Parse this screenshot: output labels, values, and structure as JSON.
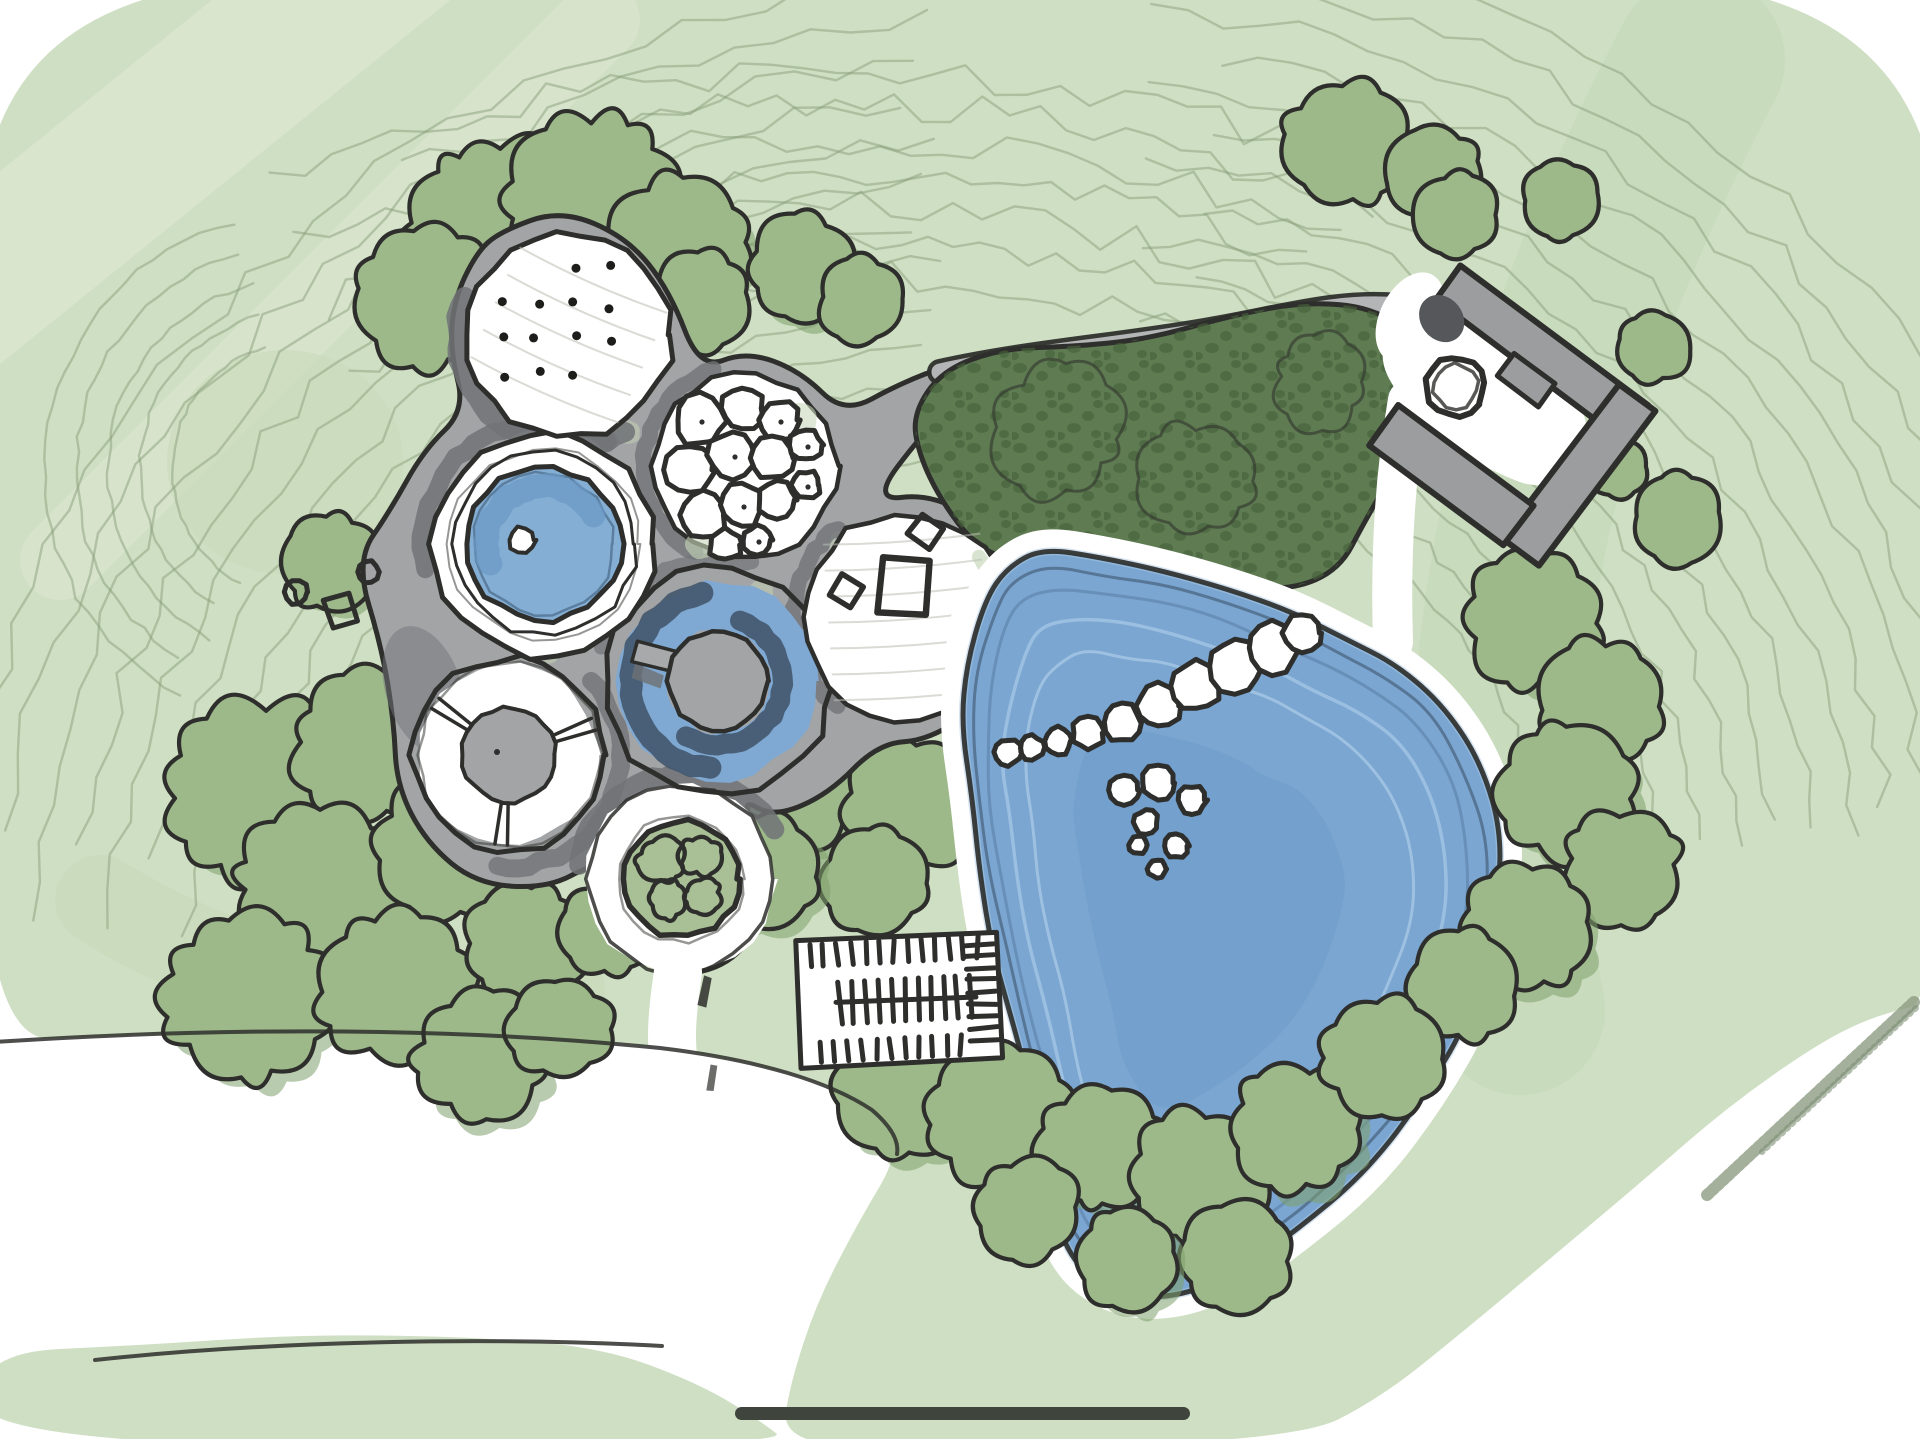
{
  "meta": {
    "description": "Hand-drawn watercolor landscape masterplan sketch",
    "drawing_type": "concept site plan"
  },
  "palette": {
    "paper": "#ffffff",
    "wash": "#cfdfc3",
    "wash_light": "#e3ebd7",
    "wash_dark": "#bed3af",
    "tree": "#9db98a",
    "tree_shade": "#7fa06b",
    "planting_dark": "#5e7b51",
    "planting_spot": "#47613c",
    "contour_line": "#8aa07c",
    "plaza_gray": "#a3a4a6",
    "plaza_shadow": "#717377",
    "road_gray": "#b4b5b6",
    "building_gray": "#9c9d9e",
    "pool_blue": "#84aed3",
    "pond_blue": "#7aa6d1",
    "water_shadow_navy": "#43566d",
    "water_band_light": "#a5c6e3",
    "charcoal_ink": "#2e2f2c",
    "pencil_gray": "#b9beb2",
    "home_indicator": "#3f443c"
  },
  "features": [
    {
      "id": "plaza-cluster",
      "label": "circular pod plaza"
    },
    {
      "id": "dotted-pod",
      "label": "stippled lawn pod"
    },
    {
      "id": "boulder-pod",
      "label": "boulder garden pod"
    },
    {
      "id": "round-pool-pod",
      "label": "circular pool pod"
    },
    {
      "id": "donut-pool-pod",
      "label": "ring pool with island"
    },
    {
      "id": "terrace-pod",
      "label": "terrace pod with tables"
    },
    {
      "id": "ring-walk-pod",
      "label": "ring walkway pod"
    },
    {
      "id": "planter-pod",
      "label": "tree planter pod"
    },
    {
      "id": "pond",
      "label": "large pond with stepping stones"
    },
    {
      "id": "dense-planting",
      "label": "dense dark planting bed"
    },
    {
      "id": "building-compound",
      "label": "courtyard building"
    },
    {
      "id": "parking-lot",
      "label": "parking lot"
    },
    {
      "id": "access-road",
      "label": "access road"
    },
    {
      "id": "home-indicator",
      "label": "handle bar"
    }
  ],
  "home_indicator": {
    "present": true
  }
}
